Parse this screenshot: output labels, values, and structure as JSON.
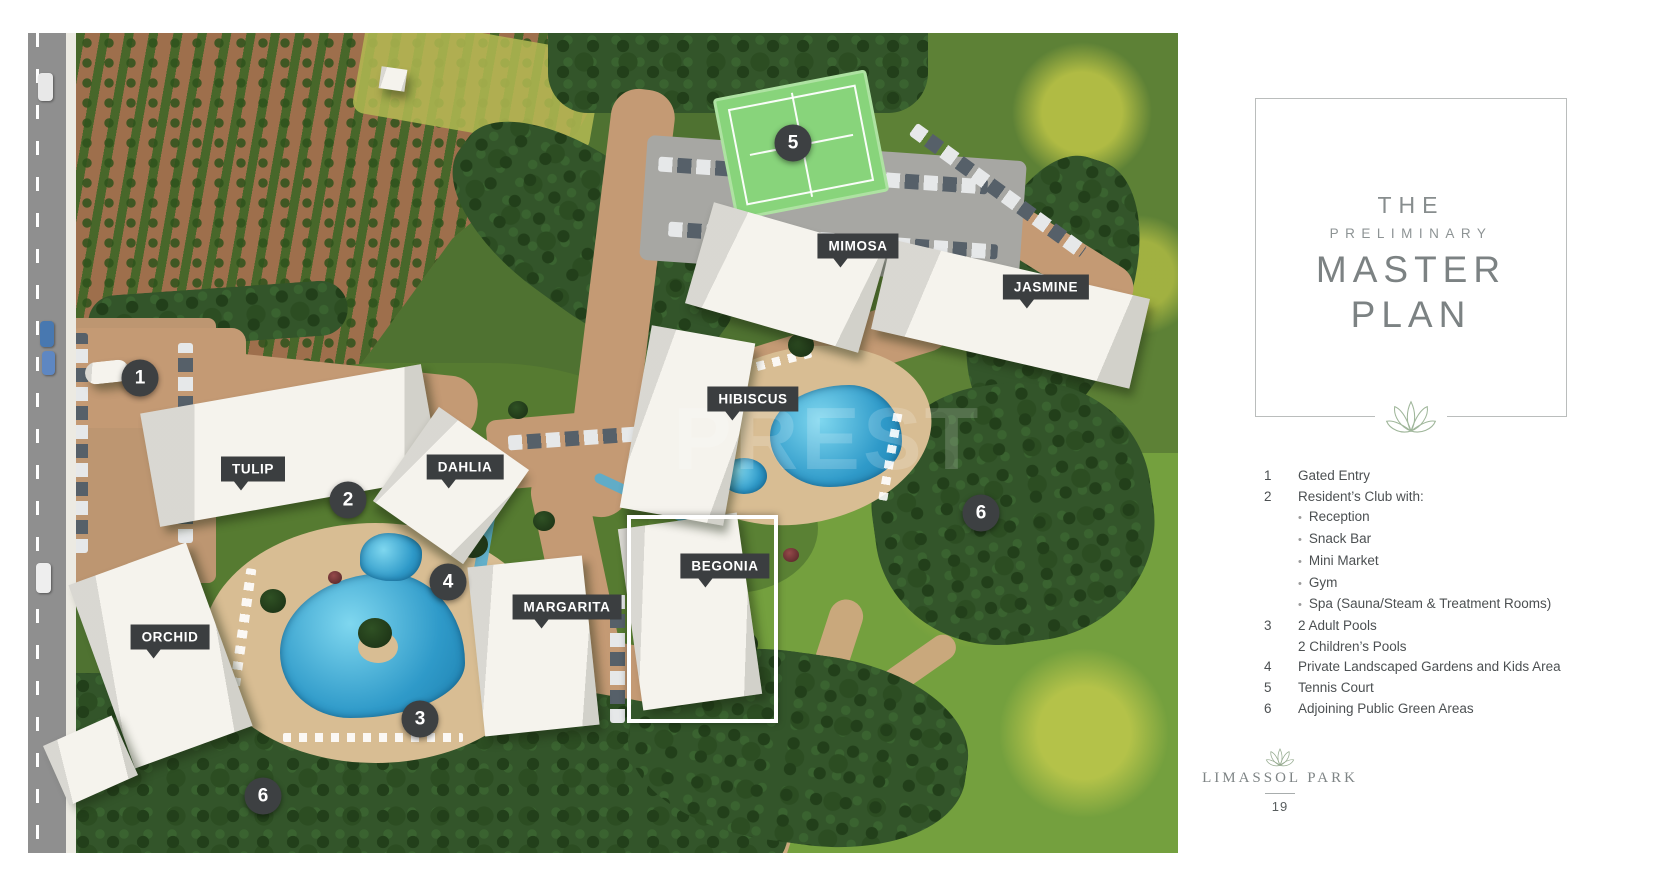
{
  "title_panel": {
    "line1": "THE",
    "line2": "PRELIMINARY",
    "line3": "MASTER",
    "line4": "PLAN"
  },
  "legend": {
    "items": [
      {
        "num": "1",
        "lines": [
          "Gated Entry"
        ],
        "bullets": []
      },
      {
        "num": "2",
        "lines": [
          "Resident’s Club with:"
        ],
        "bullets": [
          "Reception",
          "Snack Bar",
          "Mini Market",
          "Gym",
          "Spa (Sauna/Steam & Treatment Rooms)"
        ]
      },
      {
        "num": "3",
        "lines": [
          "2 Adult Pools",
          "2 Children’s Pools"
        ],
        "bullets": []
      },
      {
        "num": "4",
        "lines": [
          "Private Landscaped Gardens and Kids Area"
        ],
        "bullets": []
      },
      {
        "num": "5",
        "lines": [
          "Tennis Court"
        ],
        "bullets": []
      },
      {
        "num": "6",
        "lines": [
          "Adjoining Public Green Areas"
        ],
        "bullets": []
      }
    ]
  },
  "footer": {
    "brand": "LIMASSOL PARK",
    "page_number": "19"
  },
  "map": {
    "watermark": "PREST",
    "building_labels": [
      {
        "key": "tulip",
        "name": "TULIP",
        "x": 225,
        "y": 436
      },
      {
        "key": "dahlia",
        "name": "DAHLIA",
        "x": 437,
        "y": 434
      },
      {
        "key": "orchid",
        "name": "ORCHID",
        "x": 142,
        "y": 604
      },
      {
        "key": "margarita",
        "name": "MARGARITA",
        "x": 539,
        "y": 574
      },
      {
        "key": "begonia",
        "name": "BEGONIA",
        "x": 697,
        "y": 533
      },
      {
        "key": "hibiscus",
        "name": "HIBISCUS",
        "x": 725,
        "y": 366
      },
      {
        "key": "mimosa",
        "name": "MIMOSA",
        "x": 830,
        "y": 213
      },
      {
        "key": "jasmine",
        "name": "JASMINE",
        "x": 1018,
        "y": 254
      }
    ],
    "markers": [
      {
        "key": "1",
        "num": "1",
        "x": 112,
        "y": 345
      },
      {
        "key": "2",
        "num": "2",
        "x": 320,
        "y": 467
      },
      {
        "key": "3",
        "num": "3",
        "x": 392,
        "y": 686
      },
      {
        "key": "4",
        "num": "4",
        "x": 420,
        "y": 549
      },
      {
        "key": "5",
        "num": "5",
        "x": 765,
        "y": 110
      },
      {
        "key": "6a",
        "num": "6",
        "x": 953,
        "y": 480
      },
      {
        "key": "6b",
        "num": "6",
        "x": 235,
        "y": 763
      }
    ]
  }
}
